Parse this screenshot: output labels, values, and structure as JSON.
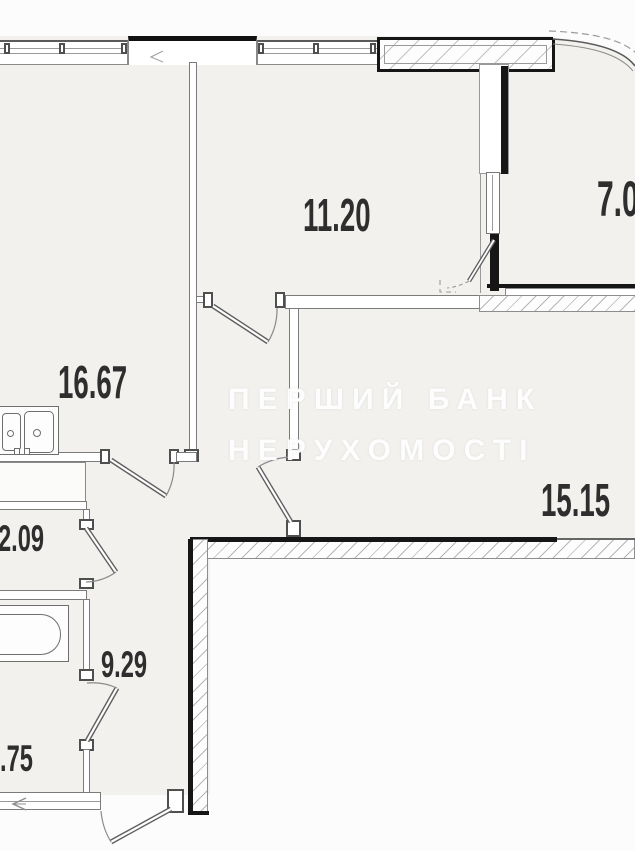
{
  "plan_title": "apartment-floor-plan",
  "rooms": {
    "kitchen": {
      "area": "16.67"
    },
    "bedroom": {
      "area": "11.20"
    },
    "loggia": {
      "area": "7.0"
    },
    "living": {
      "area": "15.15"
    },
    "closet": {
      "area": "2.09"
    },
    "hall": {
      "area": "9.29"
    },
    "bathroom": {
      "area": ".75"
    }
  },
  "watermark": {
    "line1": "ПЕРШИЙ БАНК",
    "line2": "НЕРУХОМОСТІ"
  },
  "fixtures": [
    "kitchen-sink",
    "bathtub",
    "vent-shaft",
    "curved-glazing"
  ],
  "colors": {
    "wall_black": "#161616",
    "wall_line": "#7b7b7b",
    "hatch_line": "#b6b6b6",
    "room_fill": "#f2f1ee",
    "label_text": "#2e2e2e",
    "watermark_text": "#ffffff"
  }
}
